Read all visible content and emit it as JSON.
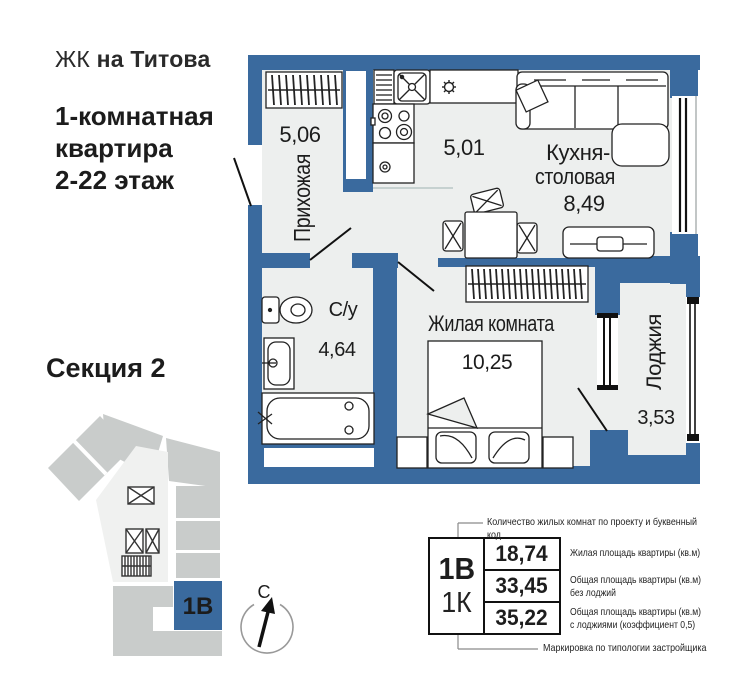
{
  "brand": {
    "prefix": "ЖК",
    "name": "на Титова"
  },
  "listing": {
    "title_line1": "1-комнатная",
    "title_line2": "квартира",
    "title_line3": "2-22 этаж"
  },
  "section": {
    "title": "Секция 2",
    "unit_code": "1В"
  },
  "compass": {
    "north": "С"
  },
  "plan": {
    "hallway": {
      "name": "Прихожая",
      "area": "5,06"
    },
    "kitchen_zone": {
      "area": "5,01"
    },
    "kitchen_dining": {
      "name_line1": "Кухня-",
      "name_line2": "столовая",
      "area": "8,49"
    },
    "bathroom": {
      "name": "С/у",
      "area": "4,64"
    },
    "living_room": {
      "name": "Жилая комната",
      "area": "10,25"
    },
    "loggia": {
      "name": "Лоджия",
      "area": "3,53"
    }
  },
  "info_table": {
    "unit_code": "1В",
    "unit_type": "1К",
    "top_note": "Количество жилых комнат по проекту и буквенный код",
    "bottom_note": "Маркировка по типологии застройщика",
    "rows": [
      {
        "value": "18,74",
        "label": "Жилая площадь квартиры (кв.м)"
      },
      {
        "value": "33,45",
        "label": "Общая площадь квартиры (кв.м)\nбез лоджий"
      },
      {
        "value": "35,22",
        "label": "Общая площадь квартиры (кв.м)\nс лоджиями (коэффициент 0,5)"
      }
    ]
  },
  "colors": {
    "wall": "#3a6a9e",
    "room_fill": "#edefee",
    "block_gray": "#c9cccb",
    "corridor": "#f0f1f0"
  }
}
